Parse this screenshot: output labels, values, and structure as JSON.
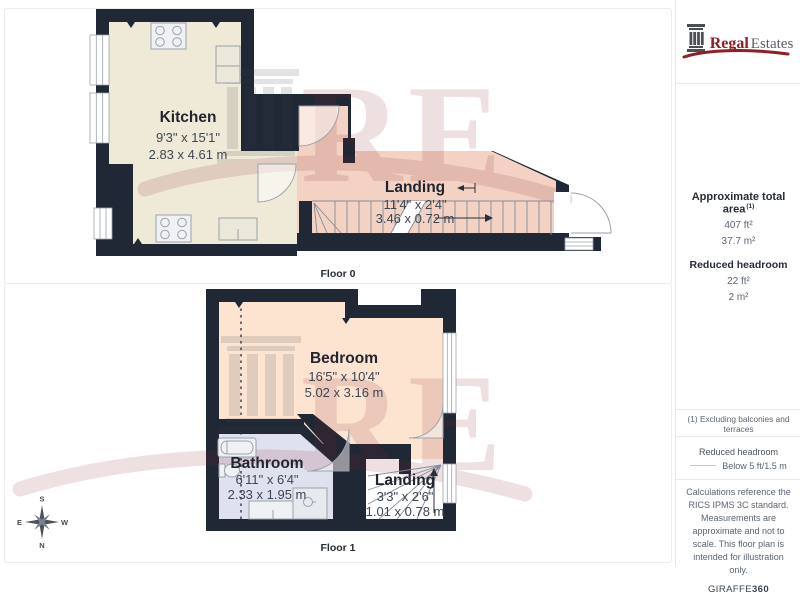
{
  "branding": {
    "logo_primary": "Regal",
    "logo_secondary": "Estates",
    "watermark_letters": "RE"
  },
  "floors": [
    {
      "caption": "Floor 0",
      "rooms": [
        {
          "name": "Kitchen",
          "dims_imperial": "9'3\" x 15'1\"",
          "dims_metric": "2.83 x 4.61 m"
        },
        {
          "name": "Landing",
          "dims_imperial": "11'4\" x 2'4\"",
          "dims_metric": "3.46 x 0.72 m"
        }
      ]
    },
    {
      "caption": "Floor 1",
      "rooms": [
        {
          "name": "Bedroom",
          "dims_imperial": "16'5\" x 10'4\"",
          "dims_metric": "5.02 x 3.16 m"
        },
        {
          "name": "Bathroom",
          "dims_imperial": "6'11\" x 6'4\"",
          "dims_metric": "2.33 x 1.95 m"
        },
        {
          "name": "Landing",
          "dims_imperial": "3'3\" x 2'6\"",
          "dims_metric": "1.01 x 0.78 m"
        }
      ]
    }
  ],
  "sidebar": {
    "total_area_label": "Approximate total area",
    "total_area_marker": "(1)",
    "total_area_imperial": "407 ft²",
    "total_area_metric": "37.7 m²",
    "reduced_headroom_label": "Reduced headroom",
    "reduced_headroom_imperial": "22 ft²",
    "reduced_headroom_metric": "2 m²",
    "footnote": "(1) Excluding balconies and terraces",
    "legend_title": "Reduced headroom",
    "legend_line_label": "Below 5 ft/1.5 m",
    "disclaimer": "Calculations reference the RICS IPMS 3C standard. Measurements are approximate and not to scale. This floor plan is intended for illustration only.",
    "provider_name": "GIRAFFE",
    "provider_suffix": "360"
  },
  "compass": {
    "top": "S",
    "bottom": "N",
    "left": "E",
    "right": "W"
  },
  "colors": {
    "wall": "#202735",
    "kitchen_floor": "#efe9d7",
    "landing0_floor": "#f3d2c3",
    "bedroom_floor": "#fce4d1",
    "bathroom_floor": "#dfe2ee",
    "landing1_floor": "#ffffff",
    "brand_red": "#8e1f24",
    "watermark_red": "#8c2630"
  }
}
